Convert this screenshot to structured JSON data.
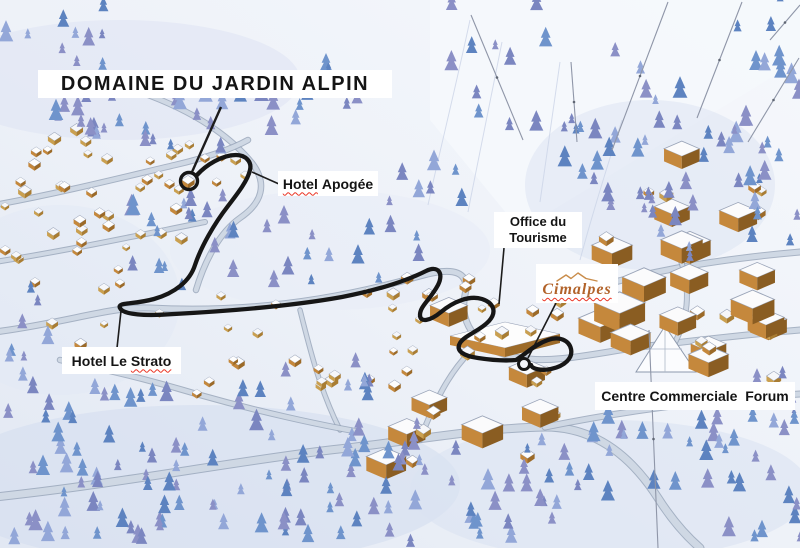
{
  "page": {
    "type": "illustrated-resort-map"
  },
  "title": "DOMAINE DU JARDIN ALPIN",
  "labels": {
    "hotel_apogee": {
      "word_flagged": "Hotel",
      "word2": "Apogée"
    },
    "office_tourisme": {
      "line1": "Office du",
      "line2": "Tourisme"
    },
    "cimalpes": {
      "text": "Cimalpes"
    },
    "hotel_le_strato": {
      "words": "Hotel Le",
      "word_flagged": "Strato"
    },
    "centre_forum": {
      "text": "Centre Commerciale  Forum"
    }
  },
  "colors": {
    "route": "#161616",
    "spellcheck_red": "#ea3323",
    "cimalpes_brand": "#b2632a",
    "snow": "#eef1f8",
    "tree_purple": "#868cc4",
    "tree_blue": "#6a90ca",
    "chalet_wall": "#c5883c",
    "road": "#cfd8e4"
  }
}
